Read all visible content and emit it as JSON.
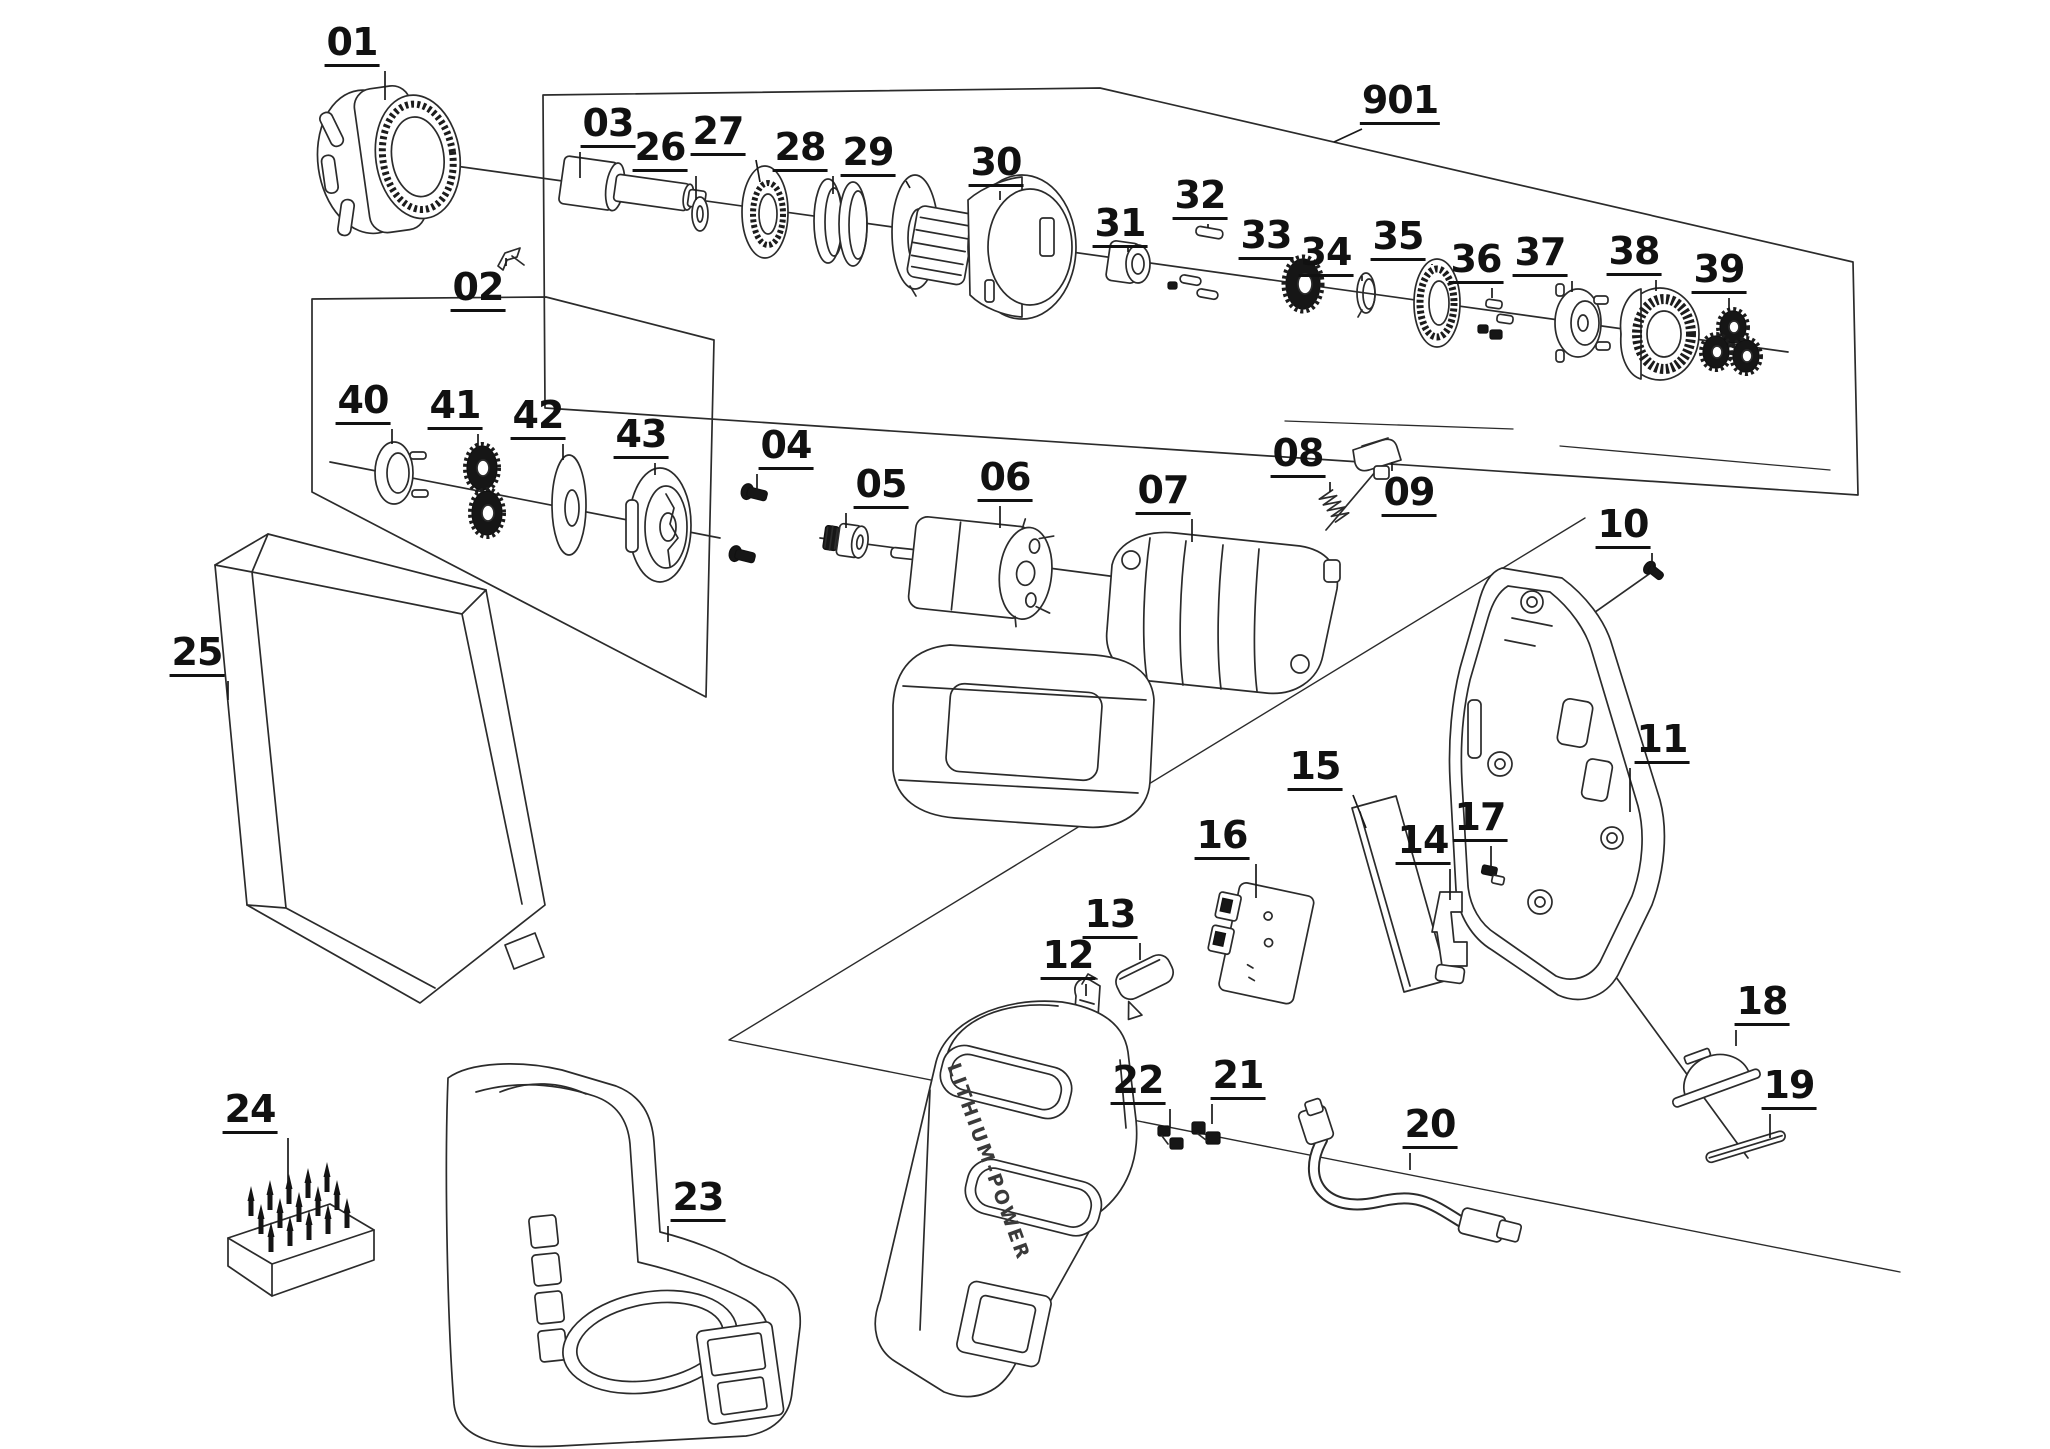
{
  "diagram": {
    "type": "exploded-parts-diagram",
    "background": "#ffffff",
    "line_color": "#2b2b2b",
    "label_color": "#111111",
    "housing_text": "LITHIUM-POWER",
    "labels": [
      {
        "id": "01",
        "x": 352,
        "y": 45,
        "tx": 385,
        "ty": 100
      },
      {
        "id": "02",
        "x": 478,
        "y": 290,
        "tx": 506,
        "ty": 258
      },
      {
        "id": "03",
        "x": 608,
        "y": 126,
        "tx": 580,
        "ty": 178
      },
      {
        "id": "26",
        "x": 660,
        "y": 150,
        "tx": 696,
        "ty": 200
      },
      {
        "id": "27",
        "x": 718,
        "y": 134,
        "tx": 760,
        "ty": 182
      },
      {
        "id": "28",
        "x": 800,
        "y": 150,
        "tx": 833,
        "ty": 194
      },
      {
        "id": "29",
        "x": 868,
        "y": 155,
        "tx": 910,
        "ty": 188
      },
      {
        "id": "30",
        "x": 996,
        "y": 165,
        "tx": 1000,
        "ty": 200
      },
      {
        "id": "31",
        "x": 1120,
        "y": 226,
        "tx": 1128,
        "ty": 248
      },
      {
        "id": "32",
        "x": 1200,
        "y": 198,
        "tx": 1208,
        "ty": 228
      },
      {
        "id": "33",
        "x": 1266,
        "y": 238,
        "tx": 1298,
        "ty": 262
      },
      {
        "id": "34",
        "x": 1326,
        "y": 255,
        "tx": 1362,
        "ty": 276
      },
      {
        "id": "35",
        "x": 1398,
        "y": 239,
        "tx": 1432,
        "ty": 264
      },
      {
        "id": "36",
        "x": 1476,
        "y": 262,
        "tx": 1492,
        "ty": 298
      },
      {
        "id": "37",
        "x": 1540,
        "y": 255,
        "tx": 1572,
        "ty": 292
      },
      {
        "id": "38",
        "x": 1634,
        "y": 254,
        "tx": 1656,
        "ty": 291
      },
      {
        "id": "39",
        "x": 1719,
        "y": 272,
        "tx": 1729,
        "ty": 315
      },
      {
        "id": "901",
        "x": 1400,
        "y": 103,
        "tx": 1334,
        "ty": 142
      },
      {
        "id": "40",
        "x": 363,
        "y": 403,
        "tx": 392,
        "ty": 444
      },
      {
        "id": "41",
        "x": 455,
        "y": 408,
        "tx": 478,
        "ty": 450
      },
      {
        "id": "42",
        "x": 538,
        "y": 418,
        "tx": 563,
        "ty": 460
      },
      {
        "id": "43",
        "x": 641,
        "y": 437,
        "tx": 655,
        "ty": 475
      },
      {
        "id": "04",
        "x": 786,
        "y": 448,
        "tx": 757,
        "ty": 490
      },
      {
        "id": "05",
        "x": 881,
        "y": 487,
        "tx": 846,
        "ty": 528
      },
      {
        "id": "06",
        "x": 1005,
        "y": 480,
        "tx": 1000,
        "ty": 528
      },
      {
        "id": "07",
        "x": 1163,
        "y": 493,
        "tx": 1192,
        "ty": 542
      },
      {
        "id": "08",
        "x": 1298,
        "y": 456,
        "tx": 1330,
        "ty": 492
      },
      {
        "id": "09",
        "x": 1409,
        "y": 495,
        "tx": 1392,
        "ty": 462
      },
      {
        "id": "10",
        "x": 1623,
        "y": 527,
        "tx": 1652,
        "ty": 570
      },
      {
        "id": "11",
        "x": 1662,
        "y": 742,
        "tx": 1630,
        "ty": 812
      },
      {
        "id": "15",
        "x": 1315,
        "y": 769,
        "tx": 1366,
        "ty": 828
      },
      {
        "id": "16",
        "x": 1222,
        "y": 838,
        "tx": 1256,
        "ty": 898
      },
      {
        "id": "17",
        "x": 1480,
        "y": 820,
        "tx": 1491,
        "ty": 870
      },
      {
        "id": "14",
        "x": 1423,
        "y": 843,
        "tx": 1450,
        "ty": 900
      },
      {
        "id": "13",
        "x": 1110,
        "y": 917,
        "tx": 1140,
        "ty": 960
      },
      {
        "id": "12",
        "x": 1068,
        "y": 958,
        "tx": 1086,
        "ty": 996
      },
      {
        "id": "22",
        "x": 1138,
        "y": 1083,
        "tx": 1170,
        "ty": 1128
      },
      {
        "id": "21",
        "x": 1238,
        "y": 1078,
        "tx": 1212,
        "ty": 1124
      },
      {
        "id": "20",
        "x": 1430,
        "y": 1127,
        "tx": 1410,
        "ty": 1170
      },
      {
        "id": "18",
        "x": 1762,
        "y": 1004,
        "tx": 1736,
        "ty": 1046
      },
      {
        "id": "19",
        "x": 1789,
        "y": 1088,
        "tx": 1770,
        "ty": 1138
      },
      {
        "id": "25",
        "x": 197,
        "y": 655,
        "tx": 228,
        "ty": 700
      },
      {
        "id": "24",
        "x": 250,
        "y": 1112,
        "tx": 288,
        "ty": 1182
      },
      {
        "id": "23",
        "x": 698,
        "y": 1200,
        "tx": 668,
        "ty": 1242
      }
    ]
  }
}
